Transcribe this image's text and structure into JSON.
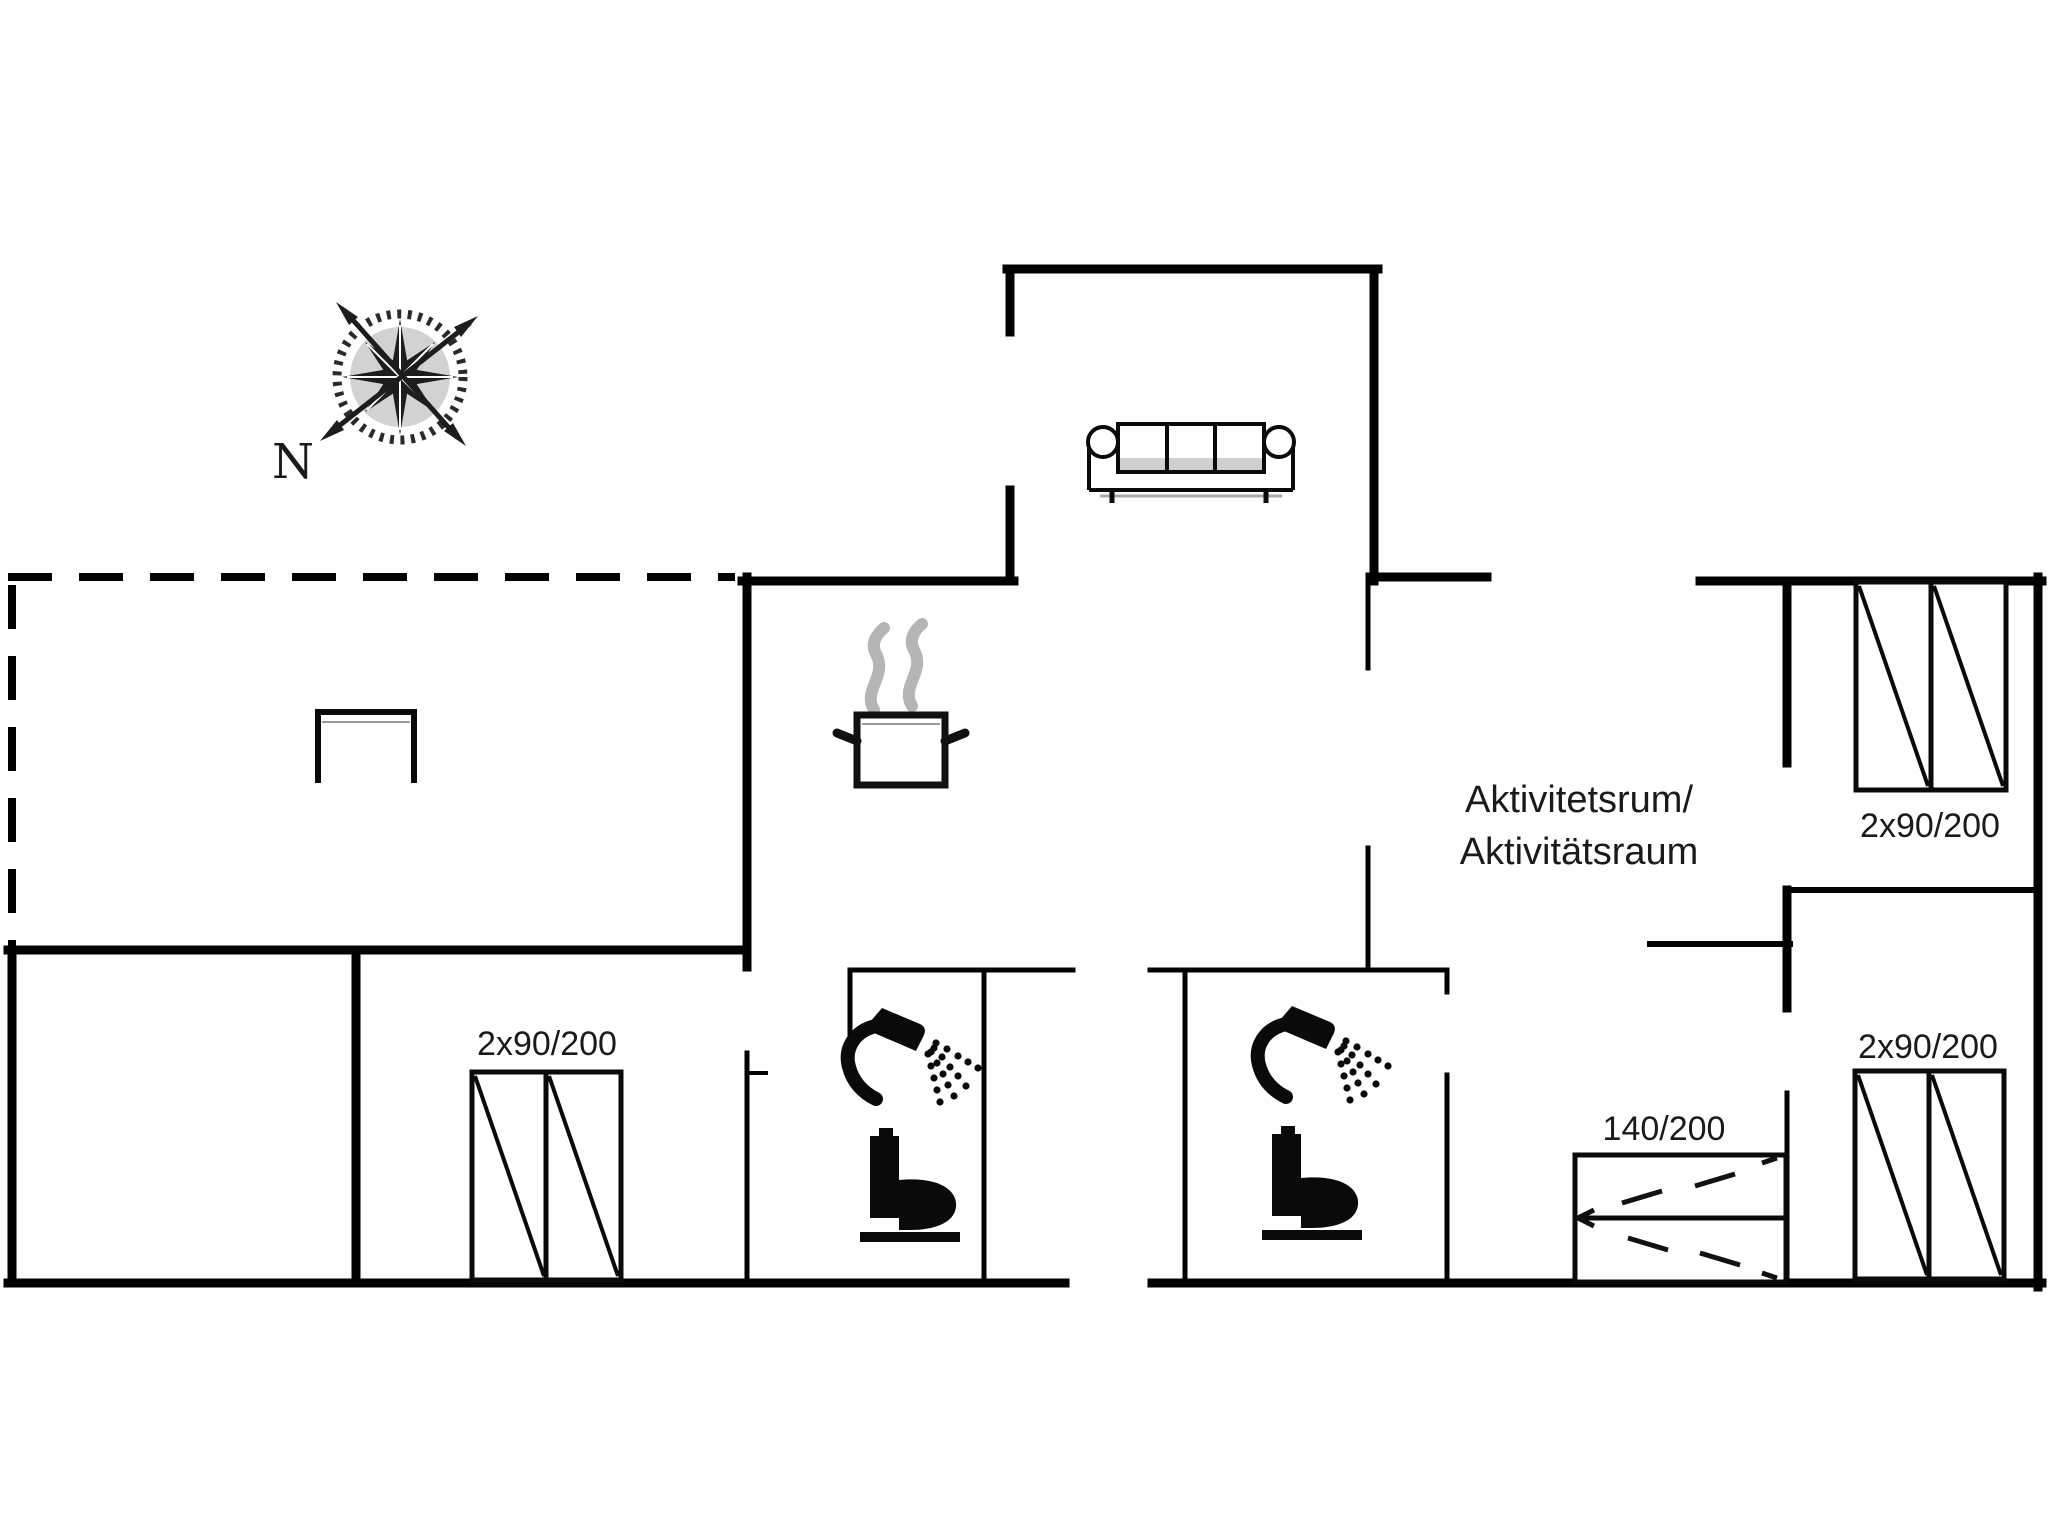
{
  "page": {
    "type": "floor-plan"
  },
  "compass": {
    "north_label": "N"
  },
  "rooms": {
    "activity_room": {
      "name_line1": "Aktivitetsrum/",
      "name_line2": "Aktivitätsraum"
    }
  },
  "beds": {
    "left_bedroom": {
      "size_label": "2x90/200"
    },
    "top_right_bedroom": {
      "size_label": "2x90/200"
    },
    "bottom_right_bedroom": {
      "size_label": "2x90/200"
    },
    "activity_room_double": {
      "size_label": "140/200"
    }
  },
  "icons": {
    "compass": "compass-rose-icon",
    "sofa": "sofa-icon",
    "cooking_pot": "cooking-pot-steam-icon",
    "shower": "shower-icon",
    "toilet": "toilet-icon",
    "fireplace": "fireplace-icon"
  },
  "colors": {
    "wall": "#000000",
    "text": "#1a1a1a",
    "steam": "#b5b5b5",
    "background": "#ffffff"
  }
}
